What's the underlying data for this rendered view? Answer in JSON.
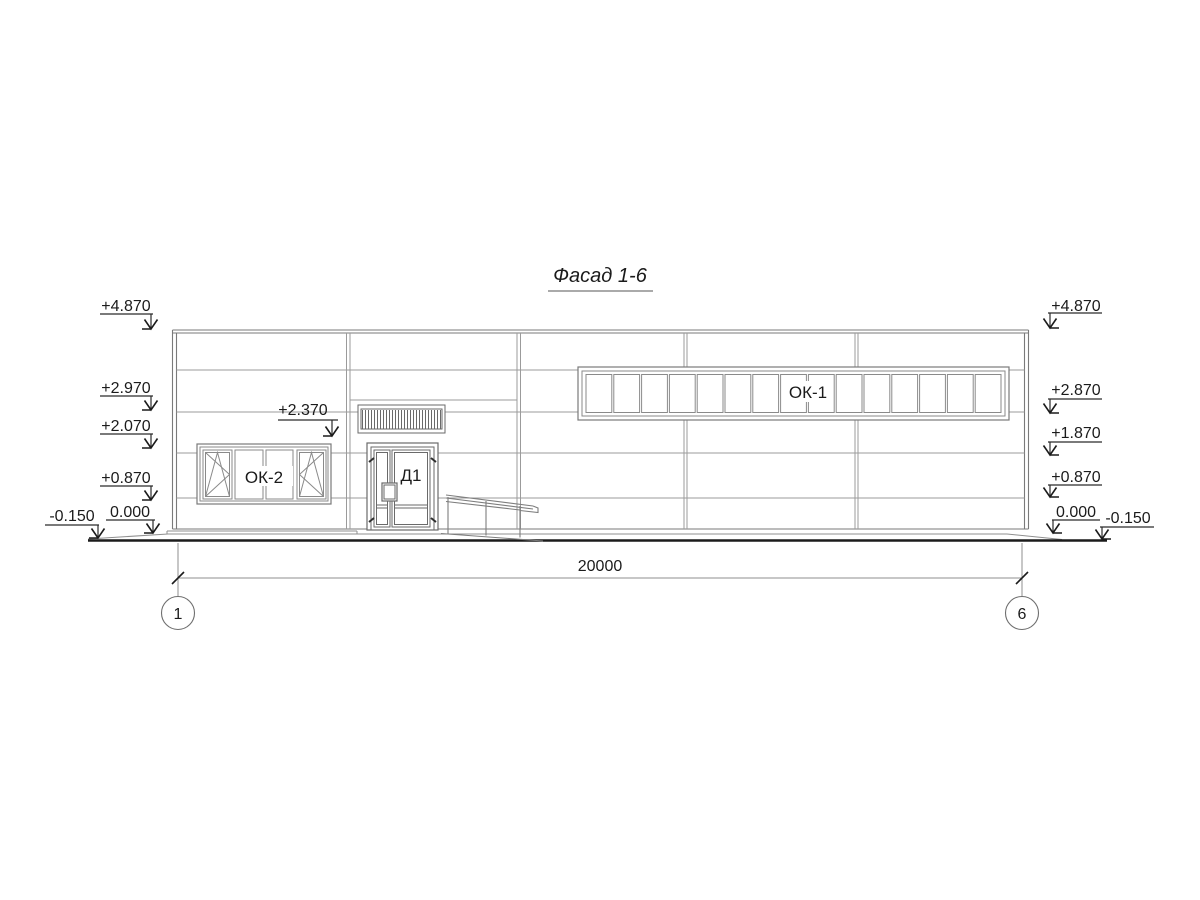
{
  "drawing_title": "Фасад 1-6",
  "elevation_marks": {
    "left": [
      "+4.870",
      "+2.970",
      "+2.070",
      "+0.870",
      "0.000",
      "-0.150"
    ],
    "right": [
      "+4.870",
      "+2.870",
      "+1.870",
      "+0.870",
      "0.000",
      "-0.150"
    ],
    "above_entrance": "+2.370"
  },
  "labels": {
    "ribbon_window": "ОК-1",
    "left_window": "ОК-2",
    "door": "Д1"
  },
  "dimension": {
    "overall": "20000"
  },
  "axes": {
    "start": "1",
    "end": "6"
  },
  "colors": {
    "paper": "#ffffff",
    "ink": "#1b1b1b",
    "line_medium": "#6f6f6f",
    "line_light": "#9b9b9b"
  }
}
